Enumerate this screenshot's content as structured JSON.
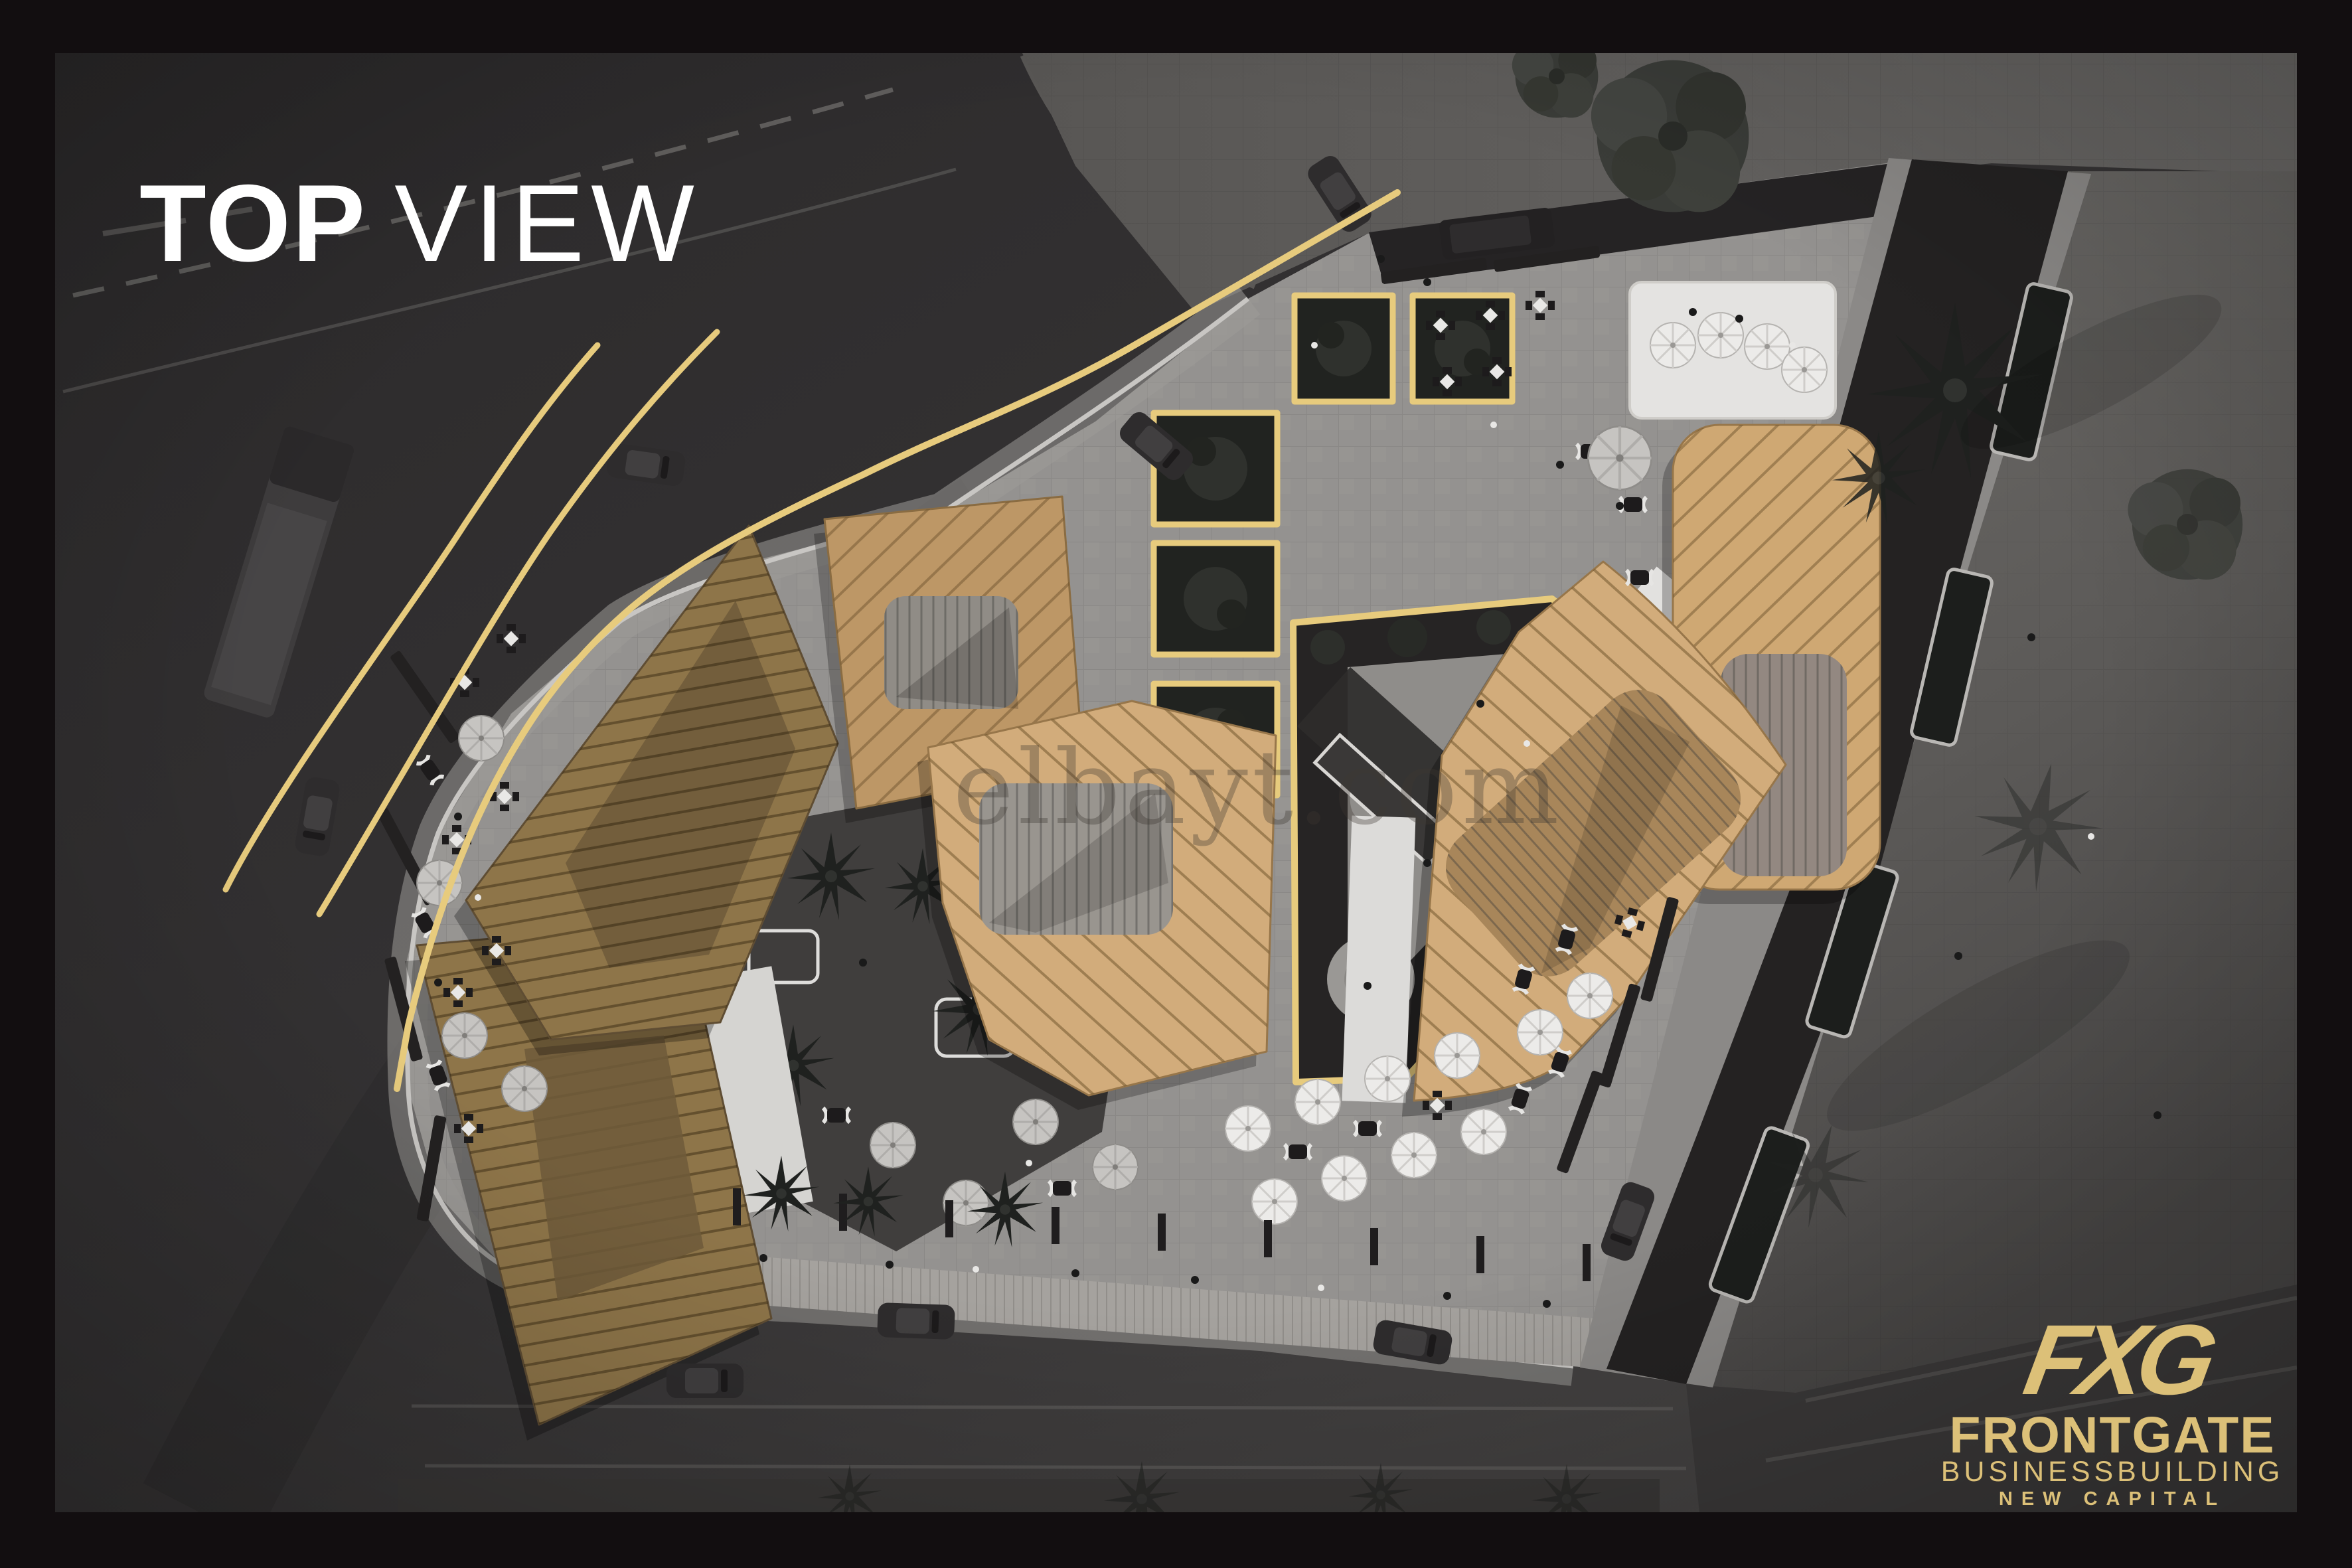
{
  "title": {
    "primary": "TOP",
    "secondary": "VIEW"
  },
  "watermark": "elbayt.com",
  "logo": {
    "monogram": "FXG",
    "brand": "FRONTGATE",
    "division": "BUSINESSBUILDING",
    "location": "NEW CAPITAL"
  },
  "colors": {
    "frame": "#120E10",
    "gold": "#E7CB7D",
    "logo-gold": "#DCC078",
    "title": "#FFFFFF",
    "watermark-ink": "#3E3832",
    "asphalt": "#323031",
    "plaza": "#949290",
    "roof-light": "#D2AC7B",
    "roof-dark": "#8E7549"
  }
}
